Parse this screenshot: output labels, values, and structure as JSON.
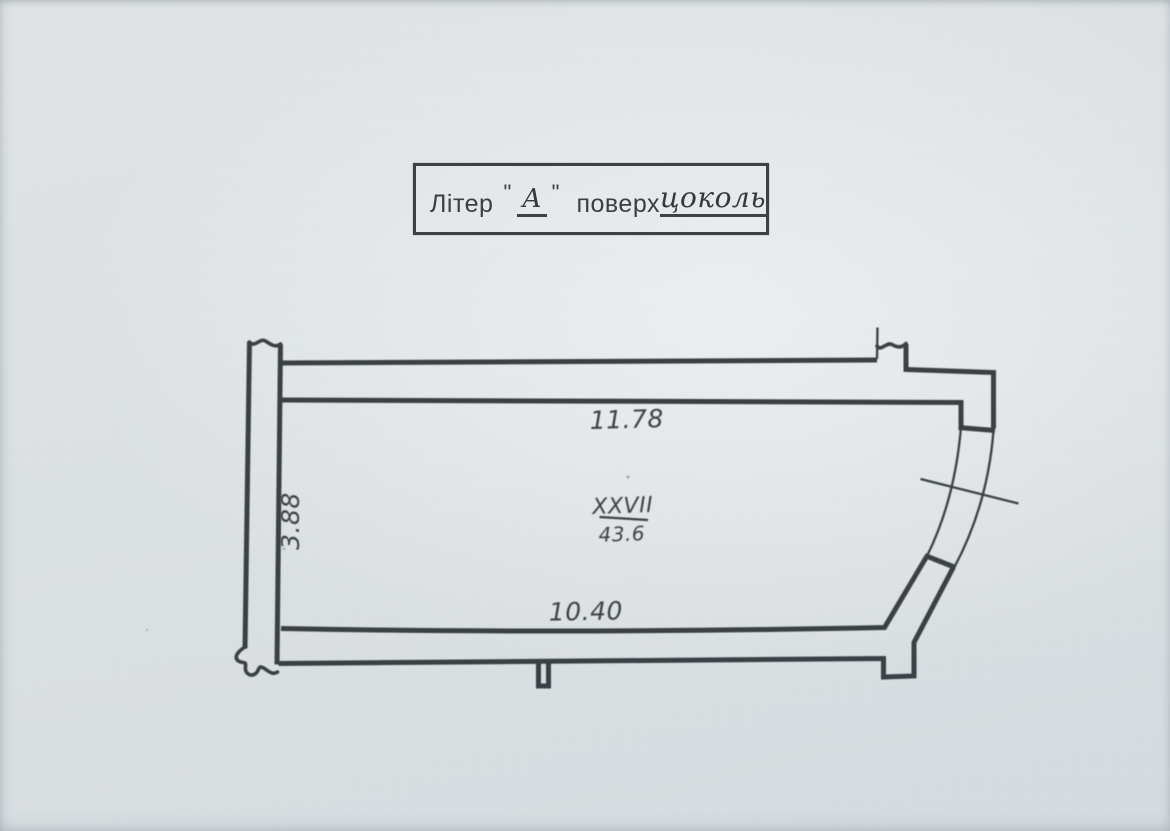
{
  "title_box": {
    "letter_label": "Літер",
    "open_quote": "\"",
    "letter_value": "А",
    "close_quote": "\"",
    "floor_label": "поверх",
    "floor_value": "цоколь"
  },
  "plan": {
    "dim_top": "11.78",
    "dim_left": "3.88",
    "dim_bottom": "10.40",
    "room_number": "XXVII",
    "room_area": "43.6"
  },
  "colors": {
    "paper": "#dce1e3",
    "ink": "#3a4044"
  }
}
